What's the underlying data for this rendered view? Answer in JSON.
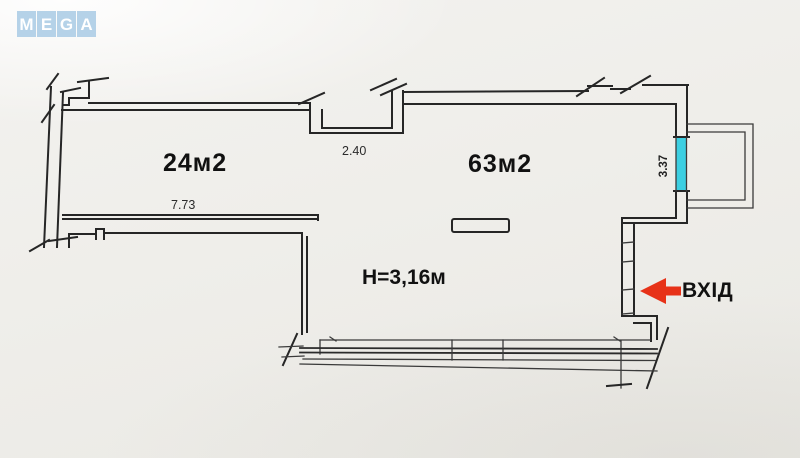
{
  "logo": {
    "letters": [
      "M",
      "E",
      "G",
      "A"
    ],
    "tile_color": "#b5d2e8",
    "letter_color": "#ffffff"
  },
  "plan": {
    "room_left": {
      "area_label": "24м2",
      "width_dimension": "7.73"
    },
    "room_right": {
      "area_label": "63м2"
    },
    "ceiling_height_label": "H=3,16м",
    "notch_width_dimension": "2.40",
    "window_length_dimension": "3.37",
    "entrance_label": "ВХІД",
    "colors": {
      "wall_line": "#262626",
      "window_highlight": "#3ccfe2",
      "entrance_arrow": "#e73218",
      "label_text": "#111111",
      "paper": "#efeeea"
    }
  }
}
